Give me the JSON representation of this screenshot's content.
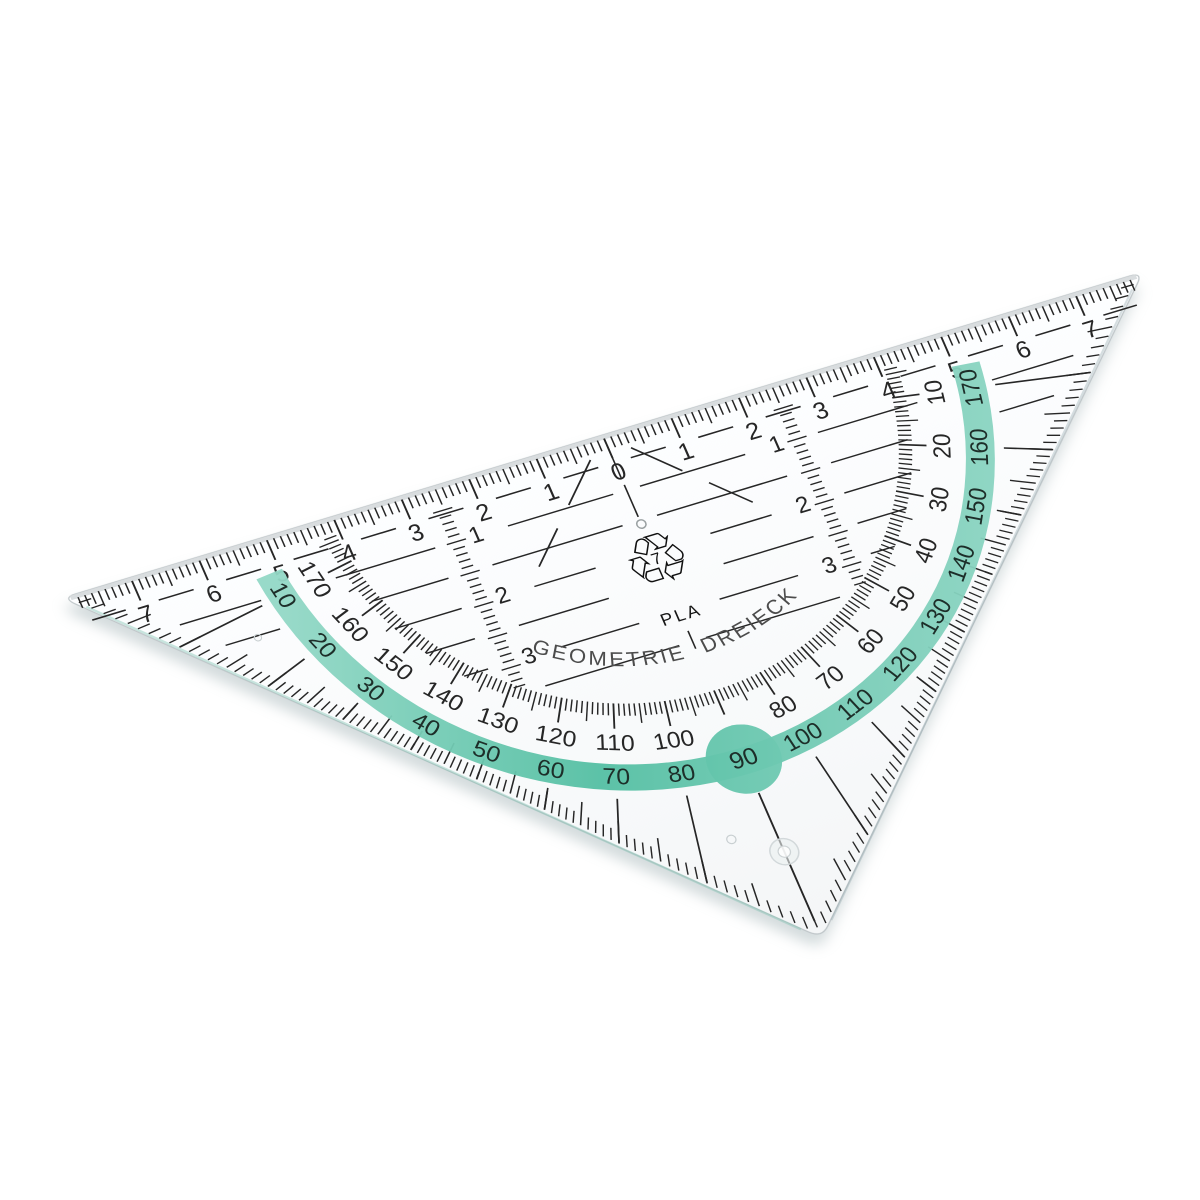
{
  "scene": {
    "description": "Transparent plastic geometry set-square (protractor triangle) photographed tilted on a white background",
    "background_color": "#ffffff"
  },
  "branding": {
    "arc_text": "GEOMETRIE DREIECK"
  },
  "material": {
    "recycling_icon": "recycling-arrows-icon",
    "recycling_glyph": "♲",
    "resin_code": "7",
    "resin_name": "PLA"
  },
  "hypotenuse_ruler": {
    "zero_label": "0",
    "cm_numbers": [
      "1",
      "2",
      "3",
      "4",
      "5",
      "6",
      "7"
    ]
  },
  "vertical_scales": {
    "cm_numbers": [
      "1",
      "2",
      "3"
    ]
  },
  "protractor": {
    "inner_scale_degrees": [
      10,
      20,
      30,
      40,
      50,
      60,
      70,
      80,
      100,
      110,
      120,
      130,
      140,
      150,
      160,
      170
    ],
    "outer_scale_degrees": [
      10,
      20,
      30,
      40,
      50,
      60,
      70,
      80,
      90,
      100,
      110,
      120,
      130,
      140,
      150,
      160,
      170
    ],
    "outer_scale_rule": "printed value = 180 - inner angle",
    "pivot_label": "90"
  },
  "colors": {
    "background": "#ffffff",
    "band_green_mid": "#54bfa3",
    "band_green_light": "#93d8c6",
    "band_green_soft": "#7cceb9",
    "band_number_ink": "#1d2e29",
    "ink": "#262626",
    "brand_text": "#4c4c4c",
    "body_edge": "#bfc6c9",
    "bevel": "#d6dadc",
    "shadow": "#9fb0b4"
  }
}
